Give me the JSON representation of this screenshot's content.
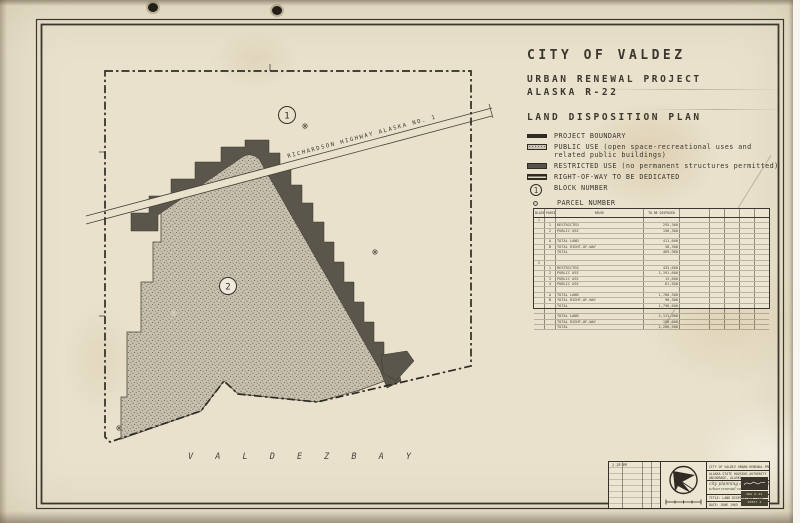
{
  "header": {
    "city": "CITY OF VALDEZ",
    "project1": "URBAN RENEWAL PROJECT",
    "project2": "ALASKA R-22",
    "plan": "LAND DISPOSITION PLAN"
  },
  "legend": {
    "items": [
      {
        "type": "boundary",
        "line1": "PROJECT BOUNDARY",
        "line2": "",
        "symbol": ""
      },
      {
        "type": "public",
        "line1": "PUBLIC USE (open space-recreational uses and",
        "line2": "related public buildings)",
        "symbol": ""
      },
      {
        "type": "restricted",
        "line1": "RESTRICTED USE (no permanent structures permitted)",
        "line2": "",
        "symbol": ""
      },
      {
        "type": "row",
        "line1": "RIGHT-OF-WAY TO BE DEDICATED",
        "line2": "",
        "symbol": ""
      },
      {
        "type": "block",
        "line1": "BLOCK NUMBER",
        "line2": "",
        "symbol": "1"
      },
      {
        "type": "parcel",
        "line1": "PARCEL NUMBER",
        "line2": "",
        "symbol": ""
      }
    ]
  },
  "map": {
    "highway_label": "RICHARDSON  HIGHWAY          ALASKA      NO. 1",
    "bay_label": "V A L D E Z      B A Y",
    "block1": "1",
    "block2": "2"
  },
  "table": {
    "headers": [
      "BLOCK",
      "PARCEL",
      "REUSE",
      "TO BE DISPOSED"
    ],
    "rows": [
      [
        "1",
        "",
        "",
        ""
      ],
      [
        "",
        "1",
        "RESTRICTED",
        "255,300"
      ],
      [
        "",
        "2",
        "PUBLIC USE",
        "156,300"
      ],
      [
        "",
        "",
        "",
        ""
      ],
      [
        "",
        "A",
        "TOTAL LAND",
        "411,600"
      ],
      [
        "",
        "B",
        "TOTAL RIGHT-OF-WAY",
        "58,300"
      ],
      [
        "",
        "",
        "TOTAL",
        "469,900"
      ],
      [
        "",
        "",
        "",
        ""
      ],
      [
        "2",
        "",
        "",
        ""
      ],
      [
        "",
        "1",
        "RESTRICTED",
        "433,600"
      ],
      [
        "",
        "2",
        "PUBLIC USE",
        "1,191,600"
      ],
      [
        "",
        "3",
        "PUBLIC USE",
        "13,600"
      ],
      [
        "",
        "4",
        "PUBLIC USE",
        "61,500"
      ],
      [
        "",
        "",
        "",
        ""
      ],
      [
        "",
        "A",
        "TOTAL LAND",
        "1,700,300"
      ],
      [
        "",
        "B",
        "TOTAL RIGHT-OF-WAY",
        "98,300"
      ],
      [
        "",
        "",
        "TOTAL",
        "1,798,600"
      ],
      [
        "",
        "",
        "",
        ""
      ],
      [
        "",
        "",
        "TOTAL LAND",
        "2,111,900"
      ],
      [
        "",
        "",
        "TOTAL RIGHT-OF-WAY",
        "156,600"
      ],
      [
        "",
        "",
        "TOTAL",
        "2,268,500"
      ]
    ]
  },
  "titleblock": {
    "project_line": "CITY OF VALDEZ URBAN RENEWAL PROJECT - ALASKA R-22",
    "agency1": "ALASKA STATE HOUSING AUTHORITY",
    "agency2": "ANCHORAGE, ALASKA",
    "firm1": "city planning associates, inc.",
    "firm2": "urban renewal consultants",
    "title_line": "TITLE: LAND DISPOSITION PLAN",
    "date_line": "DATE: JUNE 1965",
    "dwg_line": "DWG R-22",
    "sheet_line": "SHEET 2",
    "rev_note": "2-28-66"
  }
}
